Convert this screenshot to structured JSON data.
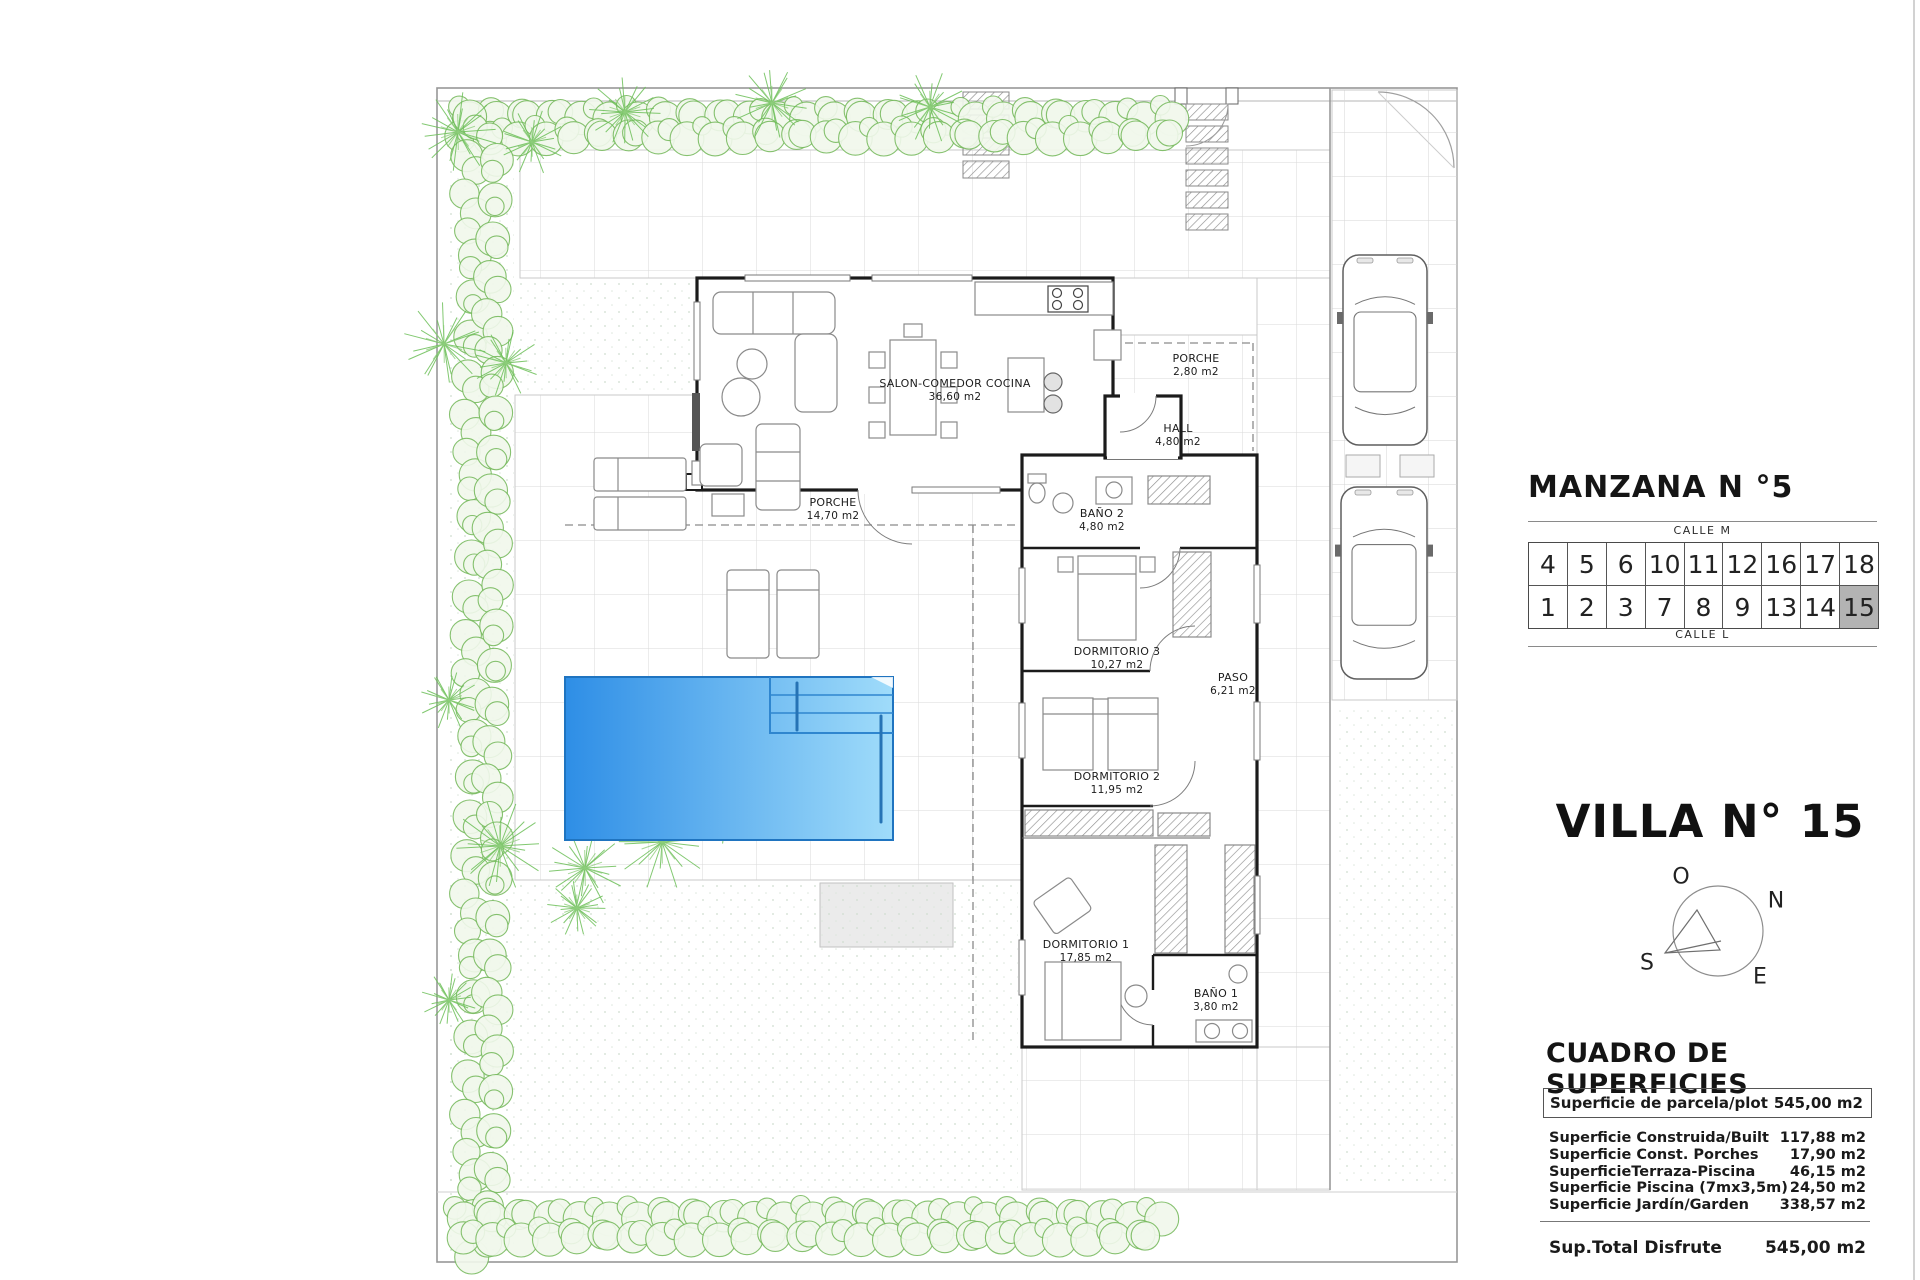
{
  "plan": {
    "rooms": [
      {
        "name": "SALON-COMEDOR COCINA",
        "area": "36,60 m2",
        "x": 955,
        "y": 391
      },
      {
        "name": "PORCHE",
        "area": "2,80 m2",
        "x": 1196,
        "y": 366
      },
      {
        "name": "HALL",
        "area": "4,80 m2",
        "x": 1178,
        "y": 436
      },
      {
        "name": "PORCHE",
        "area": "14,70 m2",
        "x": 833,
        "y": 510
      },
      {
        "name": "BAÑO 2",
        "area": "4,80 m2",
        "x": 1102,
        "y": 521
      },
      {
        "name": "DORMITORIO 3",
        "area": "10,27 m2",
        "x": 1117,
        "y": 659
      },
      {
        "name": "PASO",
        "area": "6,21 m2",
        "x": 1233,
        "y": 685
      },
      {
        "name": "DORMITORIO 2",
        "area": "11,95 m2",
        "x": 1117,
        "y": 784
      },
      {
        "name": "DORMITORIO 1",
        "area": "17,85 m2",
        "x": 1086,
        "y": 952
      },
      {
        "name": "BAÑO 1",
        "area": "3,80 m2",
        "x": 1216,
        "y": 1001
      }
    ]
  },
  "panel": {
    "manzana_title": "MANZANA N °5",
    "calle_top": "CALLE M",
    "calle_bottom": "CALLE L",
    "block_rows": [
      [
        "4",
        "5",
        "6",
        "10",
        "11",
        "12",
        "16",
        "17",
        "18"
      ],
      [
        "1",
        "2",
        "3",
        "7",
        "8",
        "9",
        "13",
        "14",
        "15"
      ]
    ],
    "highlighted_plot": "15",
    "highlight_color": "#b3b3b3",
    "villa_title": "VILLA N° 15",
    "compass": {
      "west": "O",
      "north": "N",
      "south": "S",
      "east": "E"
    },
    "surfaces_title": "CUADRO DE SUPERFICIES",
    "parcel_row": {
      "label": "Superficie de parcela/plot",
      "value": "545,00 m2"
    },
    "surface_rows": [
      {
        "label": "Superficie Construida/Built",
        "value": "117,88 m2"
      },
      {
        "label": "Superficie Const. Porches",
        "value": "17,90 m2"
      },
      {
        "label": "SuperficieTerraza-Piscina",
        "value": "46,15 m2"
      },
      {
        "label": "Superficie Piscina (7mx3,5m)",
        "value": "24,50 m2"
      },
      {
        "label": "Superficie Jardín/Garden",
        "value": "338,57 m2"
      }
    ],
    "total_row": {
      "label": "Sup.Total Disfrute",
      "value": "545,00 m2"
    },
    "pool_colors": {
      "deep": "#2e8ee6",
      "shallow": "#a0dcfa"
    }
  }
}
